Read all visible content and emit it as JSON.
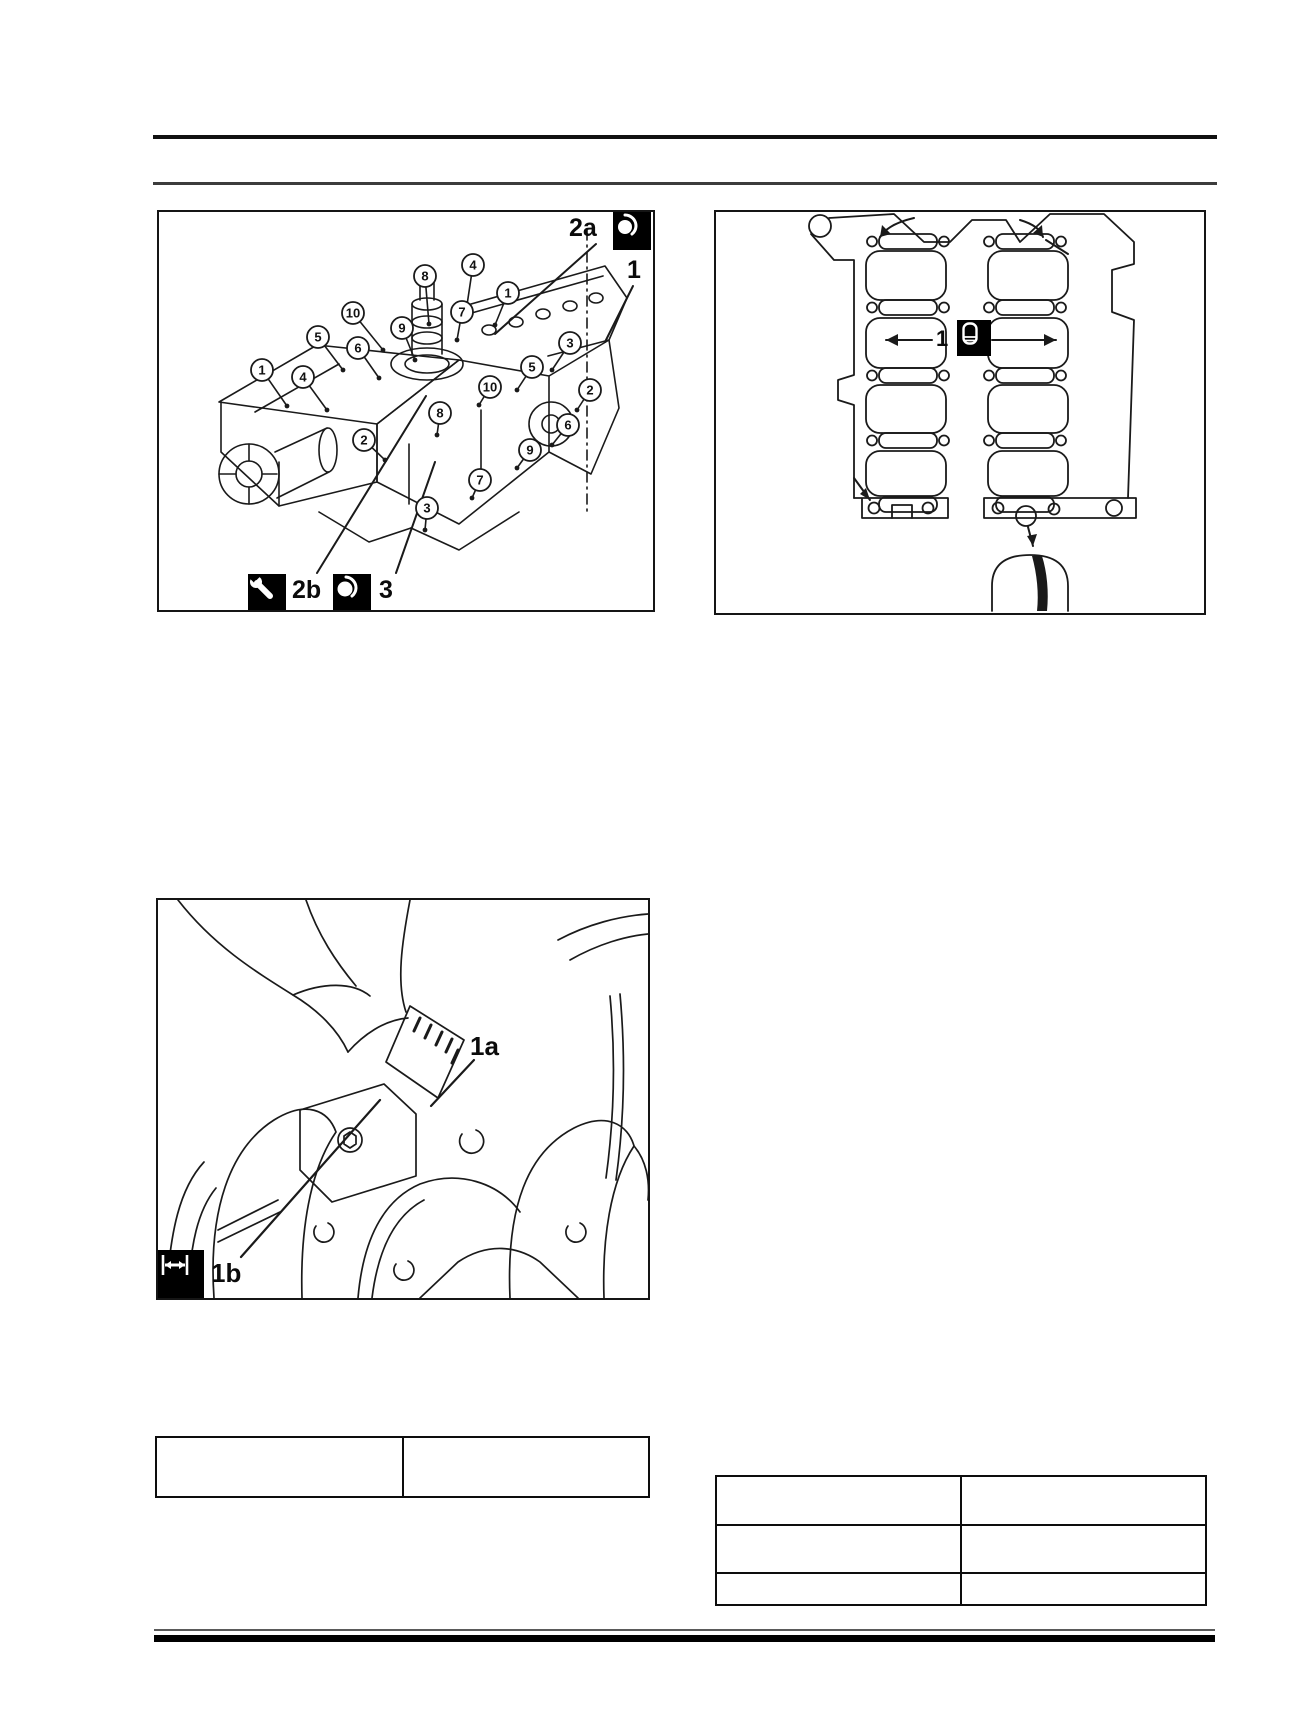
{
  "page": {
    "background": "#ffffff",
    "ink": "#1a1a1a"
  },
  "figures": {
    "engine_assembly": {
      "description": "engine block front view with numbered fastener callouts",
      "corner_step_label": "2a",
      "corner_icon": "seal-lubricant-icon",
      "part_label": "1",
      "bottom_steps": [
        {
          "icon": "wrench-icon",
          "label": "2b"
        },
        {
          "icon": "seal-lubricant-icon",
          "label": "3"
        }
      ],
      "callouts": [
        {
          "n": "1",
          "x": 103,
          "y": 158,
          "tx": 128,
          "ty": 194
        },
        {
          "n": "4",
          "x": 144,
          "y": 165,
          "tx": 168,
          "ty": 198
        },
        {
          "n": "5",
          "x": 159,
          "y": 125,
          "tx": 184,
          "ty": 158
        },
        {
          "n": "6",
          "x": 199,
          "y": 136,
          "tx": 220,
          "ty": 166
        },
        {
          "n": "10",
          "x": 194,
          "y": 101,
          "tx": 224,
          "ty": 138
        },
        {
          "n": "9",
          "x": 243,
          "y": 116,
          "tx": 256,
          "ty": 148
        },
        {
          "n": "8",
          "x": 266,
          "y": 64,
          "tx": 270,
          "ty": 112
        },
        {
          "n": "4",
          "x": 314,
          "y": 53,
          "tx": 308,
          "ty": 93
        },
        {
          "n": "1",
          "x": 349,
          "y": 81,
          "tx": 336,
          "ty": 113
        },
        {
          "n": "7",
          "x": 303,
          "y": 100,
          "tx": 298,
          "ty": 128
        },
        {
          "n": "3",
          "x": 411,
          "y": 131,
          "tx": 393,
          "ty": 158
        },
        {
          "n": "5",
          "x": 373,
          "y": 155,
          "tx": 358,
          "ty": 178
        },
        {
          "n": "10",
          "x": 331,
          "y": 175,
          "tx": 320,
          "ty": 193
        },
        {
          "n": "2",
          "x": 205,
          "y": 228,
          "tx": 226,
          "ty": 248
        },
        {
          "n": "8",
          "x": 281,
          "y": 201,
          "tx": 278,
          "ty": 223
        },
        {
          "n": "6",
          "x": 409,
          "y": 213,
          "tx": 393,
          "ty": 233
        },
        {
          "n": "9",
          "x": 371,
          "y": 238,
          "tx": 358,
          "ty": 256
        },
        {
          "n": "7",
          "x": 321,
          "y": 268,
          "tx": 313,
          "ty": 286
        },
        {
          "n": "3",
          "x": 268,
          "y": 296,
          "tx": 266,
          "ty": 318
        },
        {
          "n": "2",
          "x": 431,
          "y": 178,
          "tx": 418,
          "ty": 198
        }
      ]
    },
    "gasket": {
      "description": "cylinder block ladder-frame gasket with sealant application points",
      "center_label": "1",
      "center_icon": "sealant-tube-icon"
    },
    "crankshaft": {
      "description": "measuring bearing clearance with gauging plastic on crankshaft journal",
      "label_a": "1a",
      "label_b": "1b",
      "label_b_icon": "measure-width-icon"
    }
  },
  "tables": {
    "left": {
      "rows": [
        [
          "",
          ""
        ]
      ]
    },
    "right": {
      "rows": [
        [
          "",
          ""
        ],
        [
          "",
          ""
        ],
        [
          "",
          ""
        ]
      ]
    }
  }
}
